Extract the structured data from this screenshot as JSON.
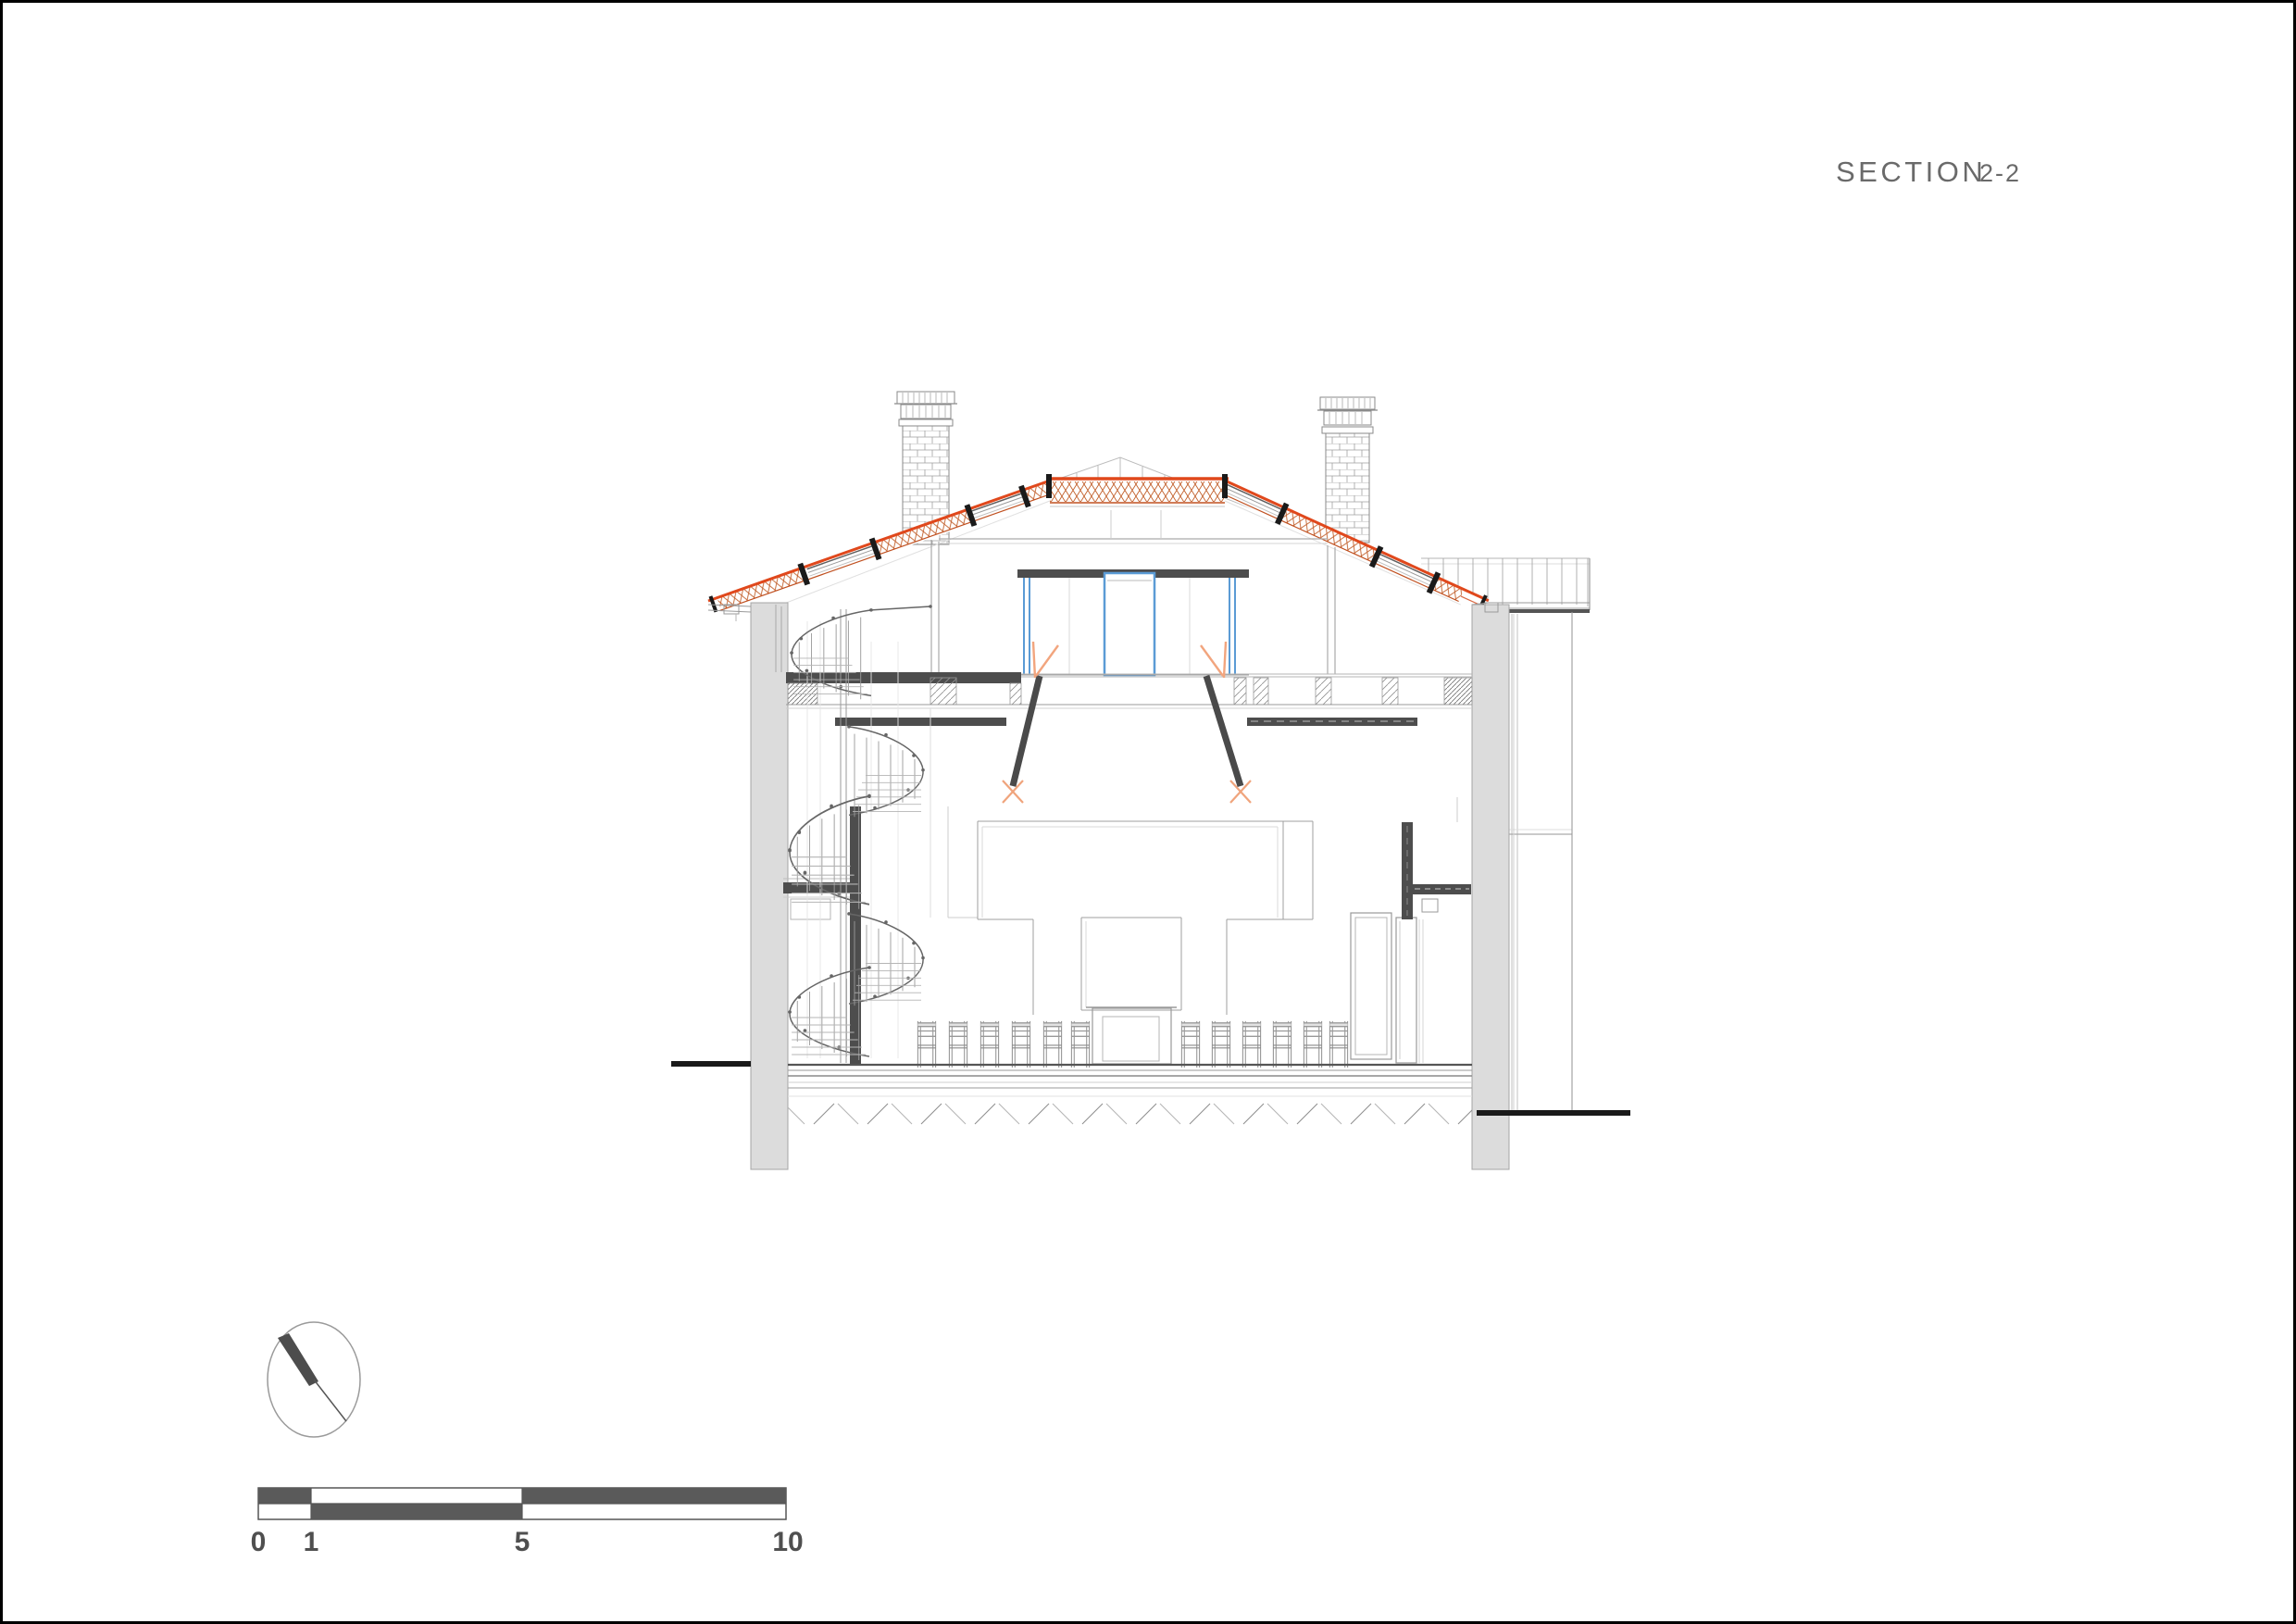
{
  "title_block": {
    "label": "SECTION",
    "number": "2-2",
    "color": "#6a6a6a"
  },
  "scale_bar": {
    "labels": [
      "0",
      "1",
      "5",
      "10"
    ],
    "dark_fill": "#5a5a5a",
    "outline": "#555555"
  },
  "compass": {
    "icon": "north-arrow-icon",
    "needle_color": "#4d4d4d"
  },
  "drawing": {
    "name": "building-cross-section",
    "view": "sectional elevation of a two-level hall with attic, gable roof, two chimneys and spiral staircase",
    "colors": {
      "roof_tile_orange": "#e0481c",
      "roof_tile_lattice": "#c2602c",
      "glazing_blue": "#5b9bd5",
      "door_swing_peach": "#f2a57e",
      "cut_element_dark": "#4a4a4a",
      "wall_poche_fill": "#dcdcdc",
      "thin_line_gray": "#9a9a9a"
    },
    "elements": [
      "gable-roof-with-tile-bands",
      "ridge-flat-band",
      "chimney-left",
      "chimney-right",
      "annex-building-right",
      "exterior-wall-left",
      "exterior-wall-right",
      "attic-glazed-partition",
      "attic-floor-slab",
      "loft-hatch-doors",
      "spiral-staircase",
      "hall-back-wall-elevation",
      "chair-row",
      "lectern",
      "double-door-right",
      "floor-assembly",
      "ground-hatch",
      "ground-line-left",
      "ground-line-right"
    ]
  }
}
